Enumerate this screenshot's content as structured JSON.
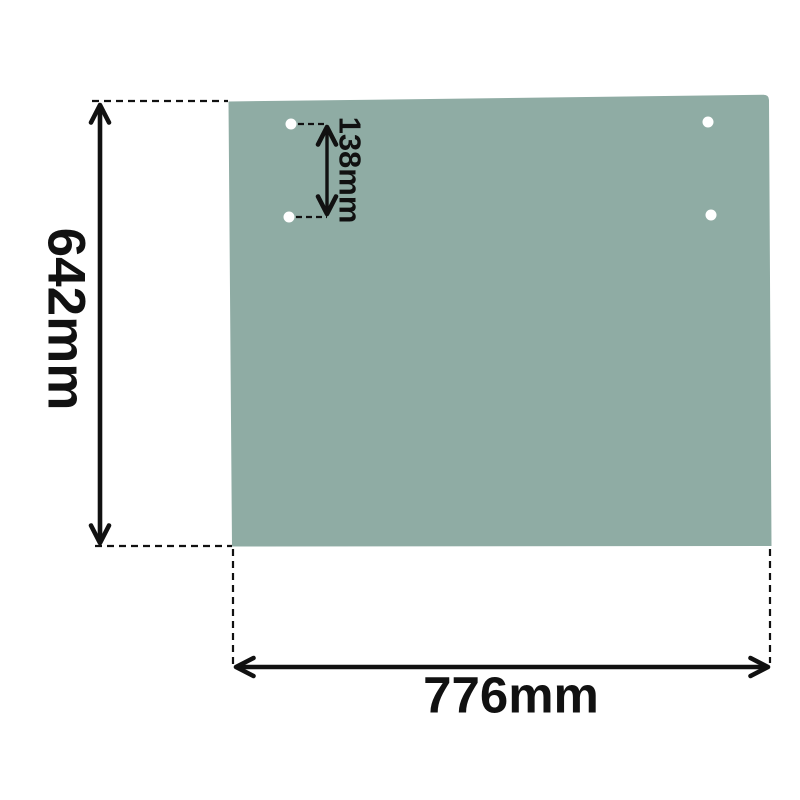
{
  "page": {
    "background_color": "#ffffff"
  },
  "diagram": {
    "kind": "technical-dimension-diagram",
    "subject": "rear glass panel with mounting holes",
    "panel": {
      "fill_color": "#8FACA4",
      "hole_color": "#ffffff",
      "hole_count": 4
    },
    "annotation": {
      "line_color": "#111111",
      "text_color": "#111111",
      "line_style": "solid arrows with dashed extension lines"
    },
    "dimensions": {
      "height": {
        "label": "642mm",
        "orientation": "vertical",
        "side": "left"
      },
      "width": {
        "label": "776mm",
        "orientation": "horizontal",
        "side": "bottom"
      },
      "hole_spacing": {
        "label": "138mm",
        "orientation": "vertical",
        "side": "top-left-holes"
      }
    }
  }
}
